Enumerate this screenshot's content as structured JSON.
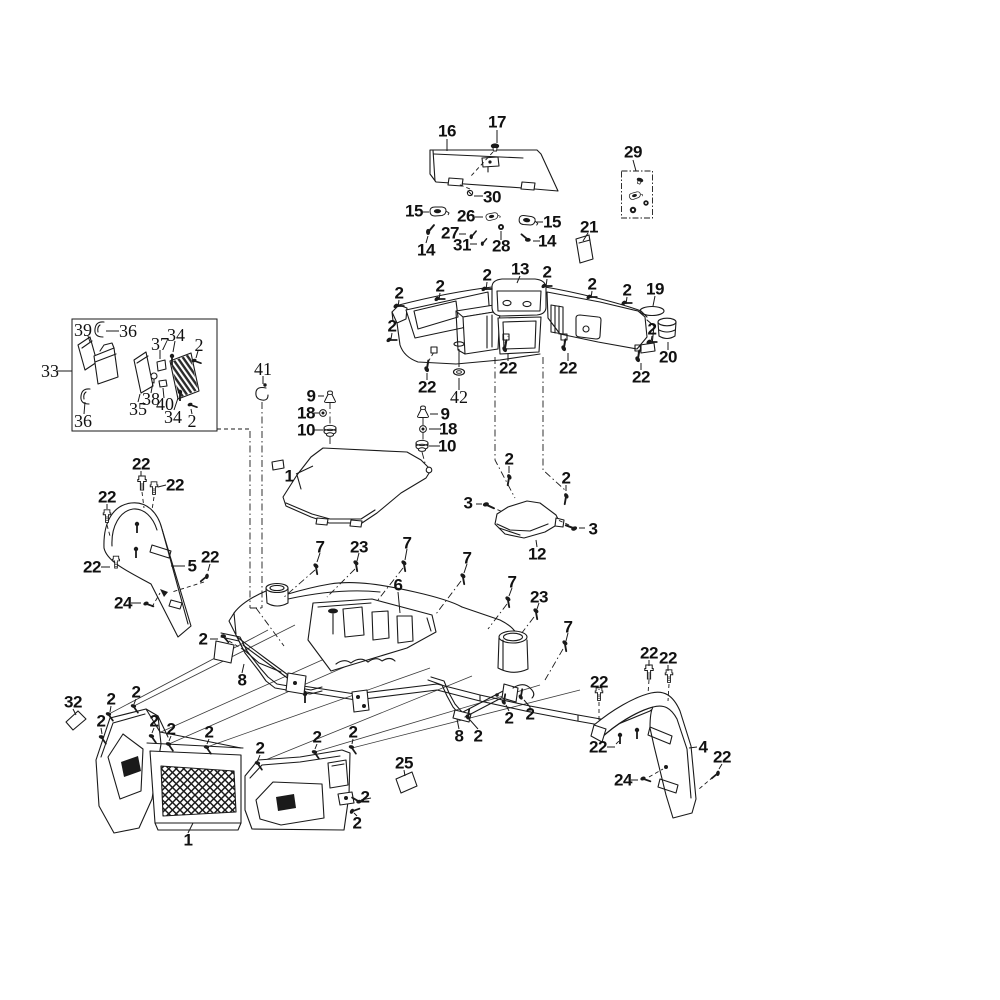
{
  "diagram": {
    "background_color": "#ffffff",
    "line_color": "#1a1a1a"
  },
  "callouts": [
    {
      "n": "16",
      "x": 447,
      "y": 131
    },
    {
      "n": "17",
      "x": 497,
      "y": 122
    },
    {
      "n": "29",
      "x": 633,
      "y": 152
    },
    {
      "n": "30",
      "x": 492,
      "y": 197
    },
    {
      "n": "15",
      "x": 414,
      "y": 211
    },
    {
      "n": "26",
      "x": 466,
      "y": 216
    },
    {
      "n": "15",
      "x": 552,
      "y": 222
    },
    {
      "n": "21",
      "x": 589,
      "y": 227
    },
    {
      "n": "27",
      "x": 450,
      "y": 233
    },
    {
      "n": "31",
      "x": 462,
      "y": 245
    },
    {
      "n": "28",
      "x": 501,
      "y": 246
    },
    {
      "n": "14",
      "x": 426,
      "y": 250
    },
    {
      "n": "14",
      "x": 547,
      "y": 241
    },
    {
      "n": "13",
      "x": 520,
      "y": 269
    },
    {
      "n": "2",
      "x": 399,
      "y": 293
    },
    {
      "n": "2",
      "x": 440,
      "y": 286
    },
    {
      "n": "2",
      "x": 487,
      "y": 275
    },
    {
      "n": "2",
      "x": 547,
      "y": 272
    },
    {
      "n": "2",
      "x": 592,
      "y": 284
    },
    {
      "n": "2",
      "x": 627,
      "y": 290
    },
    {
      "n": "2",
      "x": 392,
      "y": 326
    },
    {
      "n": "19",
      "x": 655,
      "y": 289
    },
    {
      "n": "2",
      "x": 652,
      "y": 329
    },
    {
      "n": "20",
      "x": 668,
      "y": 357
    },
    {
      "n": "22",
      "x": 427,
      "y": 387
    },
    {
      "n": "22",
      "x": 508,
      "y": 368
    },
    {
      "n": "22",
      "x": 568,
      "y": 368
    },
    {
      "n": "22",
      "x": 641,
      "y": 377
    },
    {
      "n": "42",
      "x": 459,
      "y": 397,
      "s": 1
    },
    {
      "n": "33",
      "x": 50,
      "y": 371,
      "s": 1
    },
    {
      "n": "39",
      "x": 83,
      "y": 330,
      "s": 1
    },
    {
      "n": "36",
      "x": 128,
      "y": 331,
      "s": 1
    },
    {
      "n": "37",
      "x": 160,
      "y": 344,
      "s": 1
    },
    {
      "n": "34",
      "x": 176,
      "y": 335,
      "s": 1
    },
    {
      "n": "2",
      "x": 199,
      "y": 345,
      "s": 1
    },
    {
      "n": "35",
      "x": 138,
      "y": 409,
      "s": 1
    },
    {
      "n": "38",
      "x": 151,
      "y": 399,
      "s": 1
    },
    {
      "n": "40",
      "x": 165,
      "y": 404,
      "s": 1
    },
    {
      "n": "34",
      "x": 173,
      "y": 417,
      "s": 1
    },
    {
      "n": "2",
      "x": 192,
      "y": 421,
      "s": 1
    },
    {
      "n": "36",
      "x": 83,
      "y": 421,
      "s": 1
    },
    {
      "n": "41",
      "x": 263,
      "y": 369,
      "s": 1
    },
    {
      "n": "9",
      "x": 311,
      "y": 396
    },
    {
      "n": "18",
      "x": 306,
      "y": 413
    },
    {
      "n": "10",
      "x": 306,
      "y": 430
    },
    {
      "n": "9",
      "x": 445,
      "y": 414
    },
    {
      "n": "18",
      "x": 448,
      "y": 429
    },
    {
      "n": "10",
      "x": 447,
      "y": 446
    },
    {
      "n": "1",
      "x": 289,
      "y": 476
    },
    {
      "n": "2",
      "x": 509,
      "y": 459
    },
    {
      "n": "2",
      "x": 566,
      "y": 478
    },
    {
      "n": "3",
      "x": 468,
      "y": 503
    },
    {
      "n": "3",
      "x": 593,
      "y": 529
    },
    {
      "n": "12",
      "x": 537,
      "y": 554
    },
    {
      "n": "22",
      "x": 141,
      "y": 464
    },
    {
      "n": "22",
      "x": 175,
      "y": 485
    },
    {
      "n": "22",
      "x": 107,
      "y": 497
    },
    {
      "n": "22",
      "x": 92,
      "y": 567
    },
    {
      "n": "5",
      "x": 192,
      "y": 566
    },
    {
      "n": "22",
      "x": 210,
      "y": 557
    },
    {
      "n": "24",
      "x": 123,
      "y": 603
    },
    {
      "n": "2",
      "x": 203,
      "y": 639
    },
    {
      "n": "7",
      "x": 320,
      "y": 547
    },
    {
      "n": "23",
      "x": 359,
      "y": 547
    },
    {
      "n": "7",
      "x": 407,
      "y": 543
    },
    {
      "n": "7",
      "x": 467,
      "y": 558
    },
    {
      "n": "7",
      "x": 512,
      "y": 582
    },
    {
      "n": "23",
      "x": 539,
      "y": 597
    },
    {
      "n": "7",
      "x": 568,
      "y": 627
    },
    {
      "n": "6",
      "x": 398,
      "y": 585
    },
    {
      "n": "8",
      "x": 242,
      "y": 680
    },
    {
      "n": "8",
      "x": 459,
      "y": 736
    },
    {
      "n": "2",
      "x": 478,
      "y": 736
    },
    {
      "n": "2",
      "x": 509,
      "y": 718
    },
    {
      "n": "2",
      "x": 530,
      "y": 714
    },
    {
      "n": "22",
      "x": 649,
      "y": 653
    },
    {
      "n": "22",
      "x": 668,
      "y": 658
    },
    {
      "n": "22",
      "x": 599,
      "y": 682
    },
    {
      "n": "22",
      "x": 598,
      "y": 747
    },
    {
      "n": "4",
      "x": 703,
      "y": 747
    },
    {
      "n": "22",
      "x": 722,
      "y": 757
    },
    {
      "n": "24",
      "x": 623,
      "y": 780
    },
    {
      "n": "32",
      "x": 73,
      "y": 702
    },
    {
      "n": "2",
      "x": 111,
      "y": 699
    },
    {
      "n": "2",
      "x": 136,
      "y": 692
    },
    {
      "n": "2",
      "x": 101,
      "y": 721
    },
    {
      "n": "2",
      "x": 154,
      "y": 721
    },
    {
      "n": "2",
      "x": 171,
      "y": 729
    },
    {
      "n": "2",
      "x": 209,
      "y": 732
    },
    {
      "n": "2",
      "x": 260,
      "y": 748
    },
    {
      "n": "2",
      "x": 317,
      "y": 737
    },
    {
      "n": "2",
      "x": 353,
      "y": 732
    },
    {
      "n": "25",
      "x": 404,
      "y": 763
    },
    {
      "n": "2",
      "x": 365,
      "y": 797
    },
    {
      "n": "2",
      "x": 357,
      "y": 823
    },
    {
      "n": "1",
      "x": 188,
      "y": 840
    }
  ]
}
